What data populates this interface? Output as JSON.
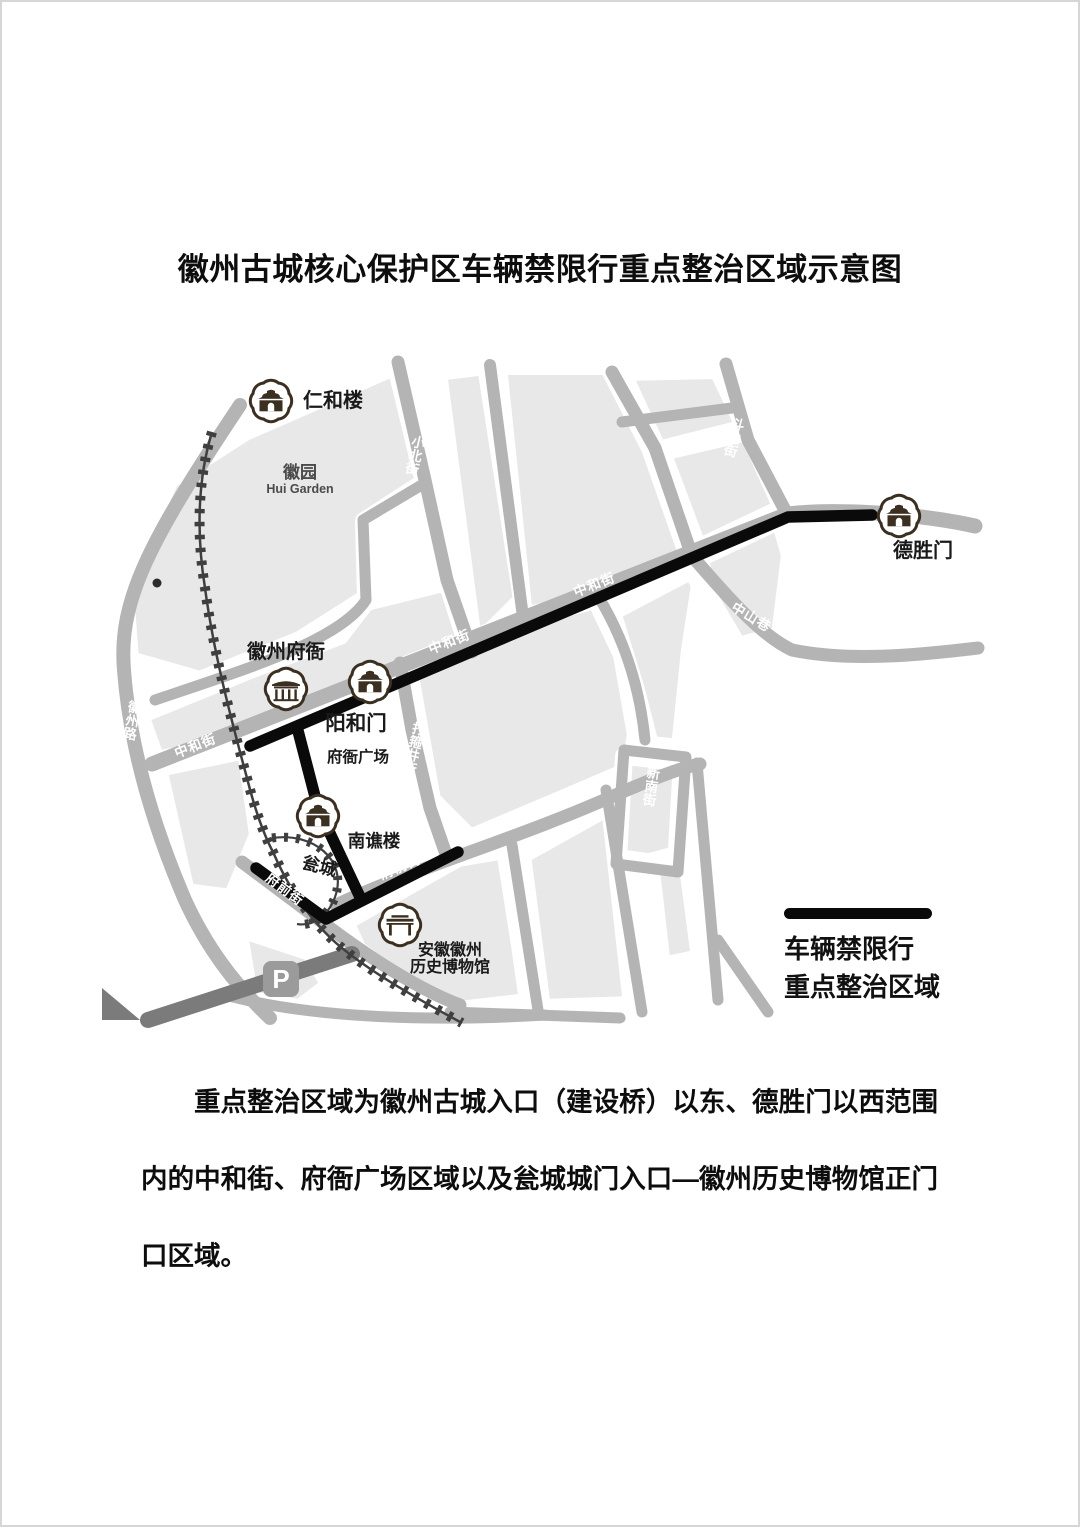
{
  "page": {
    "title": "徽州古城核心保护区车辆禁限行重点整治区域示意图"
  },
  "legend": {
    "line1": "车辆禁限行",
    "line2": "重点整治区域"
  },
  "caption": {
    "text": "重点整治区域为徽州古城入口（建设桥）以东、德胜门以西范围内的中和街、府衙广场区域以及瓮城城门入口—徽州历史博物馆正门口区域。"
  },
  "map": {
    "landmarks": {
      "renhelou": {
        "label": "仁和楼"
      },
      "huiyuan": {
        "label": "徽园",
        "label_en": "Hui Garden"
      },
      "huizhoufuya": {
        "label": "徽州府衙"
      },
      "yanghemen": {
        "label": "阳和门"
      },
      "fuyaguangchang": {
        "label": "府衙广场"
      },
      "nanqiaolou": {
        "label": "南谯楼"
      },
      "wengcheng": {
        "label": "瓮城"
      },
      "museum": {
        "label_line1": "安徽徽州",
        "label_line2": "历史博物馆"
      },
      "deshengmen": {
        "label": "德胜门"
      },
      "parking": {
        "label": "P"
      }
    },
    "streets": {
      "zhonghejie": "中和街",
      "xiaobeijie": "小北街",
      "dagujingjie": "打箍井街",
      "doushanjie": "斗山街",
      "zhongshanxiang": "中山巷",
      "xinnanjie": "新南街",
      "fuqianjie": "府前街",
      "huizhoulu": "徽州路"
    },
    "colors": {
      "block": "#e8e8e8",
      "road": "#b4b4b4",
      "road_dark": "#7b7b7b",
      "restricted_line": "#0a0a0a",
      "wall": "#3f3f3f",
      "icon": "#3b2f21",
      "street_label": "#ffffff"
    }
  }
}
